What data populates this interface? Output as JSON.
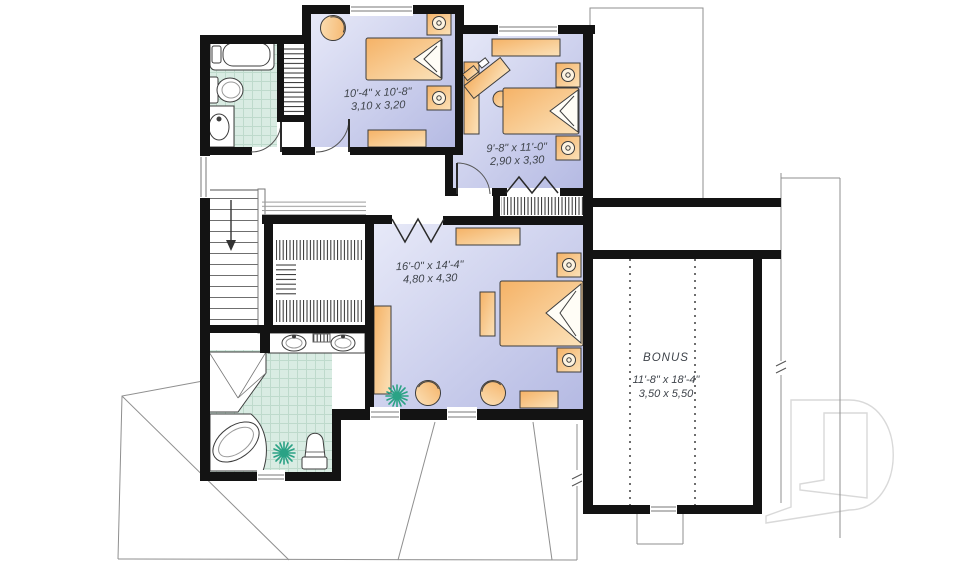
{
  "plan": {
    "type": "second-floor-plan",
    "rooms": {
      "bedroom1": {
        "imperial": "10'-4\" x 10'-8\"",
        "metric": "3,10 x 3,20"
      },
      "bedroom2": {
        "imperial": "9'-8\" x 11'-0\"",
        "metric": "2,90 x 3,30"
      },
      "master": {
        "imperial": "16'-0\" x 14'-4\"",
        "metric": "4,80 x 4,30"
      },
      "bonus": {
        "name": "BONUS",
        "imperial": "11'-8\" x 18'-4\"",
        "metric": "3,50 x 5,50"
      }
    },
    "watermark_letter": "D",
    "fixtures": [
      "bathtub",
      "toilet",
      "pedestal-sink",
      "double-vanity-sinks",
      "corner-shower",
      "corner-tub",
      "stairs-down",
      "walk-in-closet",
      "linen-closet",
      "bed",
      "nightstand-lamp",
      "armchair",
      "round-chair",
      "desk",
      "dresser",
      "bench",
      "side-table",
      "plant"
    ],
    "colors": {
      "wall": "#131313",
      "bedroom_floor_light": "#e7e9f8",
      "bedroom_floor_dark": "#b5bae3",
      "bath_tile": "#d9ece3",
      "bath_tile_line": "#bedacc",
      "furniture_light": "#fbe2ba",
      "furniture_dark": "#f5b266",
      "plant_green": "#2aa285",
      "label_text": "#3f444b",
      "roof_line": "#8f8f8f"
    }
  }
}
